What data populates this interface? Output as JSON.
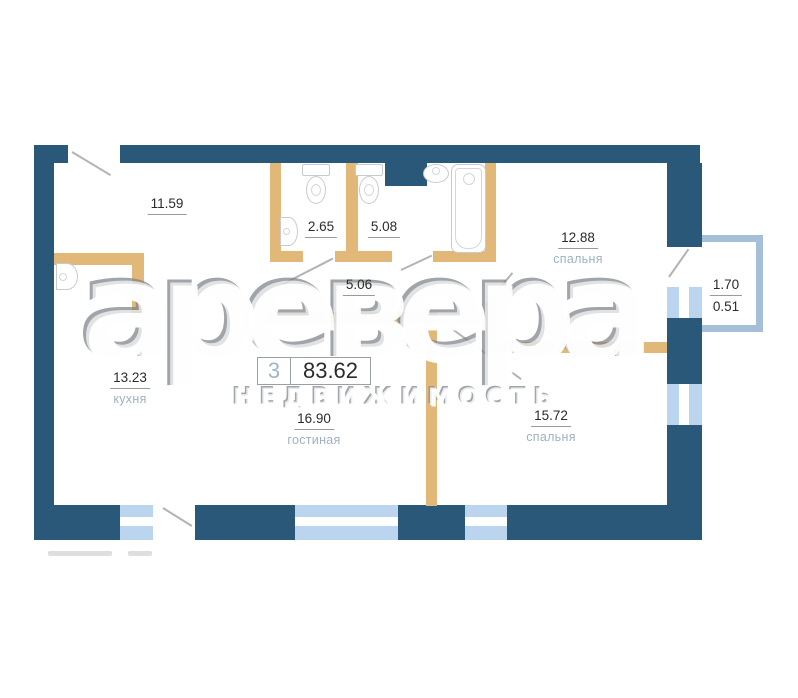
{
  "colors": {
    "wall_navy": "#2a5878",
    "wall_tan": "#e2b878",
    "window_blue": "#bcd5ee",
    "balcony_outline": "#a5bfd8",
    "label_gray": "#9fb1c0",
    "text_dark": "#2b2b2b",
    "badge_blue": "#9fb6c9",
    "door_line": "#b3b3b3",
    "fixture_line": "#c7cbd0"
  },
  "watermark": {
    "brand": "аревера",
    "subtitle": "НЕДВИЖИМОСТЬ"
  },
  "badge": {
    "rooms_count": "3",
    "total_area": "83.62"
  },
  "rooms": {
    "hallway": {
      "area": "11.59",
      "name": ""
    },
    "wc": {
      "area": "2.65",
      "name": ""
    },
    "bathroom": {
      "area": "5.08",
      "name": ""
    },
    "bedroom_top": {
      "area": "12.88",
      "name": "спальня"
    },
    "corridor": {
      "area": "5.06",
      "name": ""
    },
    "kitchen": {
      "area": "13.23",
      "name": "кухня"
    },
    "living_room": {
      "area": "16.90",
      "name": "гостиная"
    },
    "bedroom_bottom": {
      "area": "15.72",
      "name": "спальня"
    },
    "balcony": {
      "area": "1.70",
      "area_reduced": "0.51",
      "name": ""
    }
  },
  "icons": {
    "fixtures": [
      "kitchen-sink-icon",
      "corner-sink-icon",
      "toilet-icon",
      "toilet-icon",
      "washbasin-icon",
      "bathtub-icon"
    ]
  }
}
